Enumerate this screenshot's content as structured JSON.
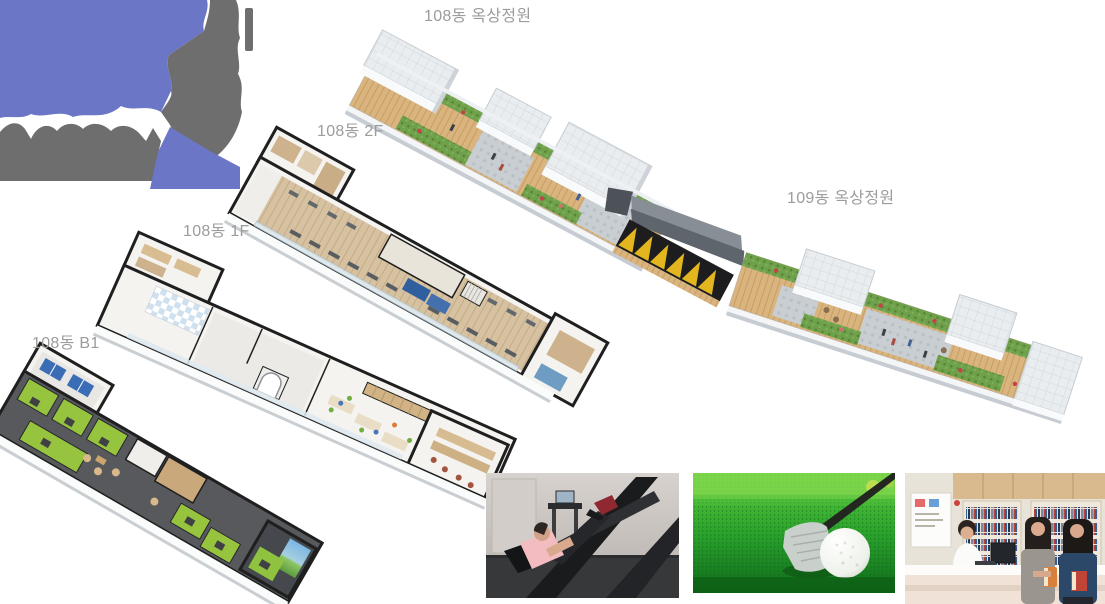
{
  "page": {
    "background": "#ffffff"
  },
  "labels": {
    "rooftop108": "108동 옥상정원",
    "rooftop109": "109동 옥상정원",
    "floor2": "108동 2F",
    "floor1": "108동 1F",
    "floorB1": "108동 B1"
  },
  "label_color": "#9c9c9c",
  "logo": {
    "blue": "#6b77c6",
    "gray": "#6e6e6e"
  },
  "palette": {
    "deck_wood": "#d9b47e",
    "grass": "#6fa04b",
    "stone_path": "#c9ced2",
    "roof_block": "#e9edf0",
    "flower_red": "#c8404a",
    "canopy_yellow": "#e3b51f",
    "canopy_black": "#1d1d1f",
    "plan_wall_black": "#1f1f1f",
    "plan_floor_white": "#f4f3f0",
    "plan_wood": "#d6c1a1",
    "b1_floor_dark": "#57595d",
    "golf_bay_green": "#96c43e",
    "pingpong_blue": "#3a6db5",
    "mat_blue": "#2f5f9f"
  },
  "photos": [
    {
      "name": "fitness-center-photo"
    },
    {
      "name": "screen-golf-photo"
    },
    {
      "name": "library-photo"
    }
  ]
}
